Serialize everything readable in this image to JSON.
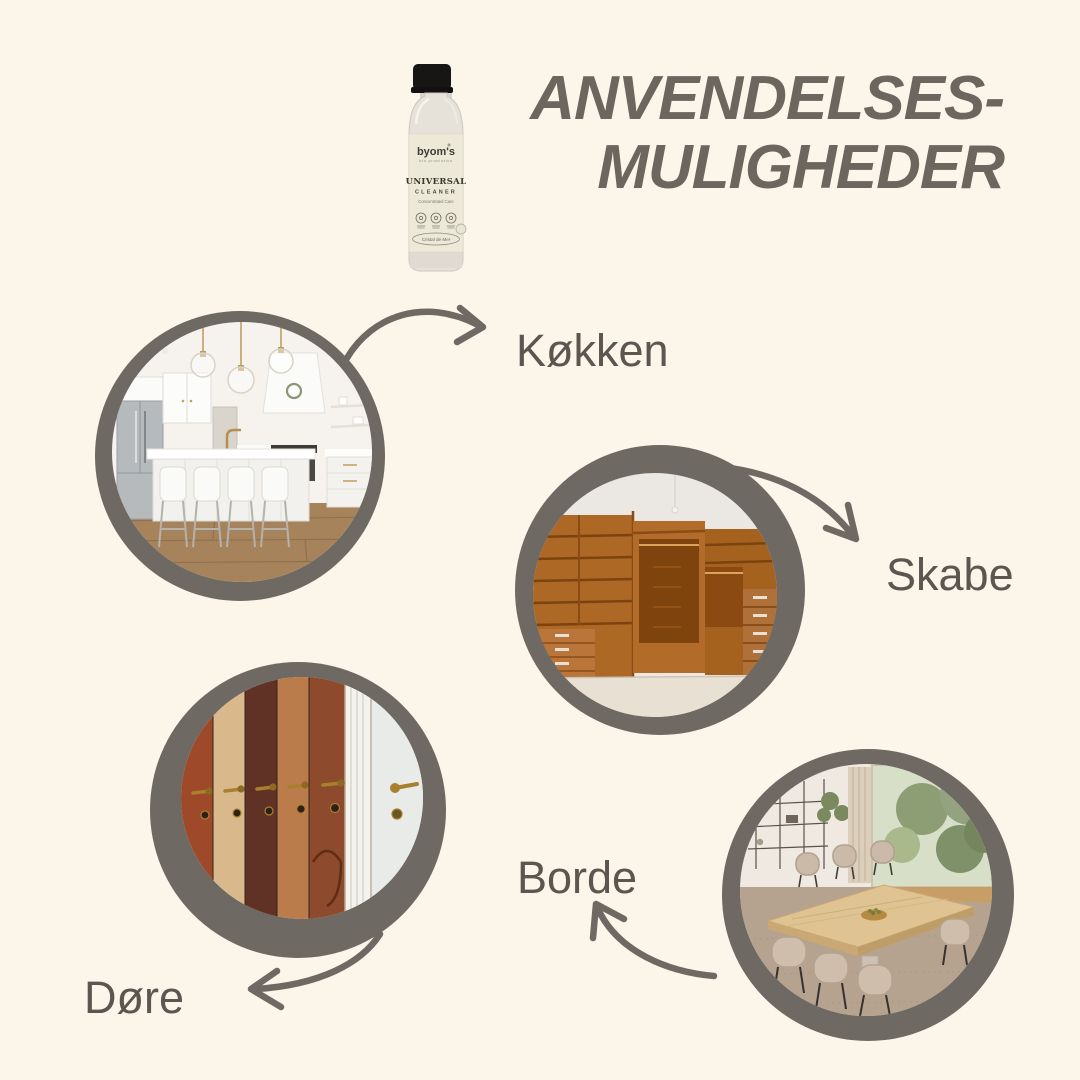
{
  "title": {
    "line1": "ANVENDELSES-",
    "line2": "MULIGHEDER"
  },
  "product": {
    "brand": "byom's",
    "tagline": "bio probiotics",
    "name_line1": "UNIVERSAL",
    "name_line2": "CLEANER",
    "subtitle": "Concentrated Care",
    "variant": "Cristal de Mer"
  },
  "use_cases": [
    {
      "id": "kitchen",
      "label": "Køkken"
    },
    {
      "id": "cabinets",
      "label": "Skabe"
    },
    {
      "id": "doors",
      "label": "Døre"
    },
    {
      "id": "tables",
      "label": "Borde"
    }
  ],
  "colors": {
    "background": "#fbf5ea",
    "ring": "#6e6962",
    "arrow": "#6e6962",
    "title_text": "#6b665e",
    "label_text": "#5b564f"
  }
}
